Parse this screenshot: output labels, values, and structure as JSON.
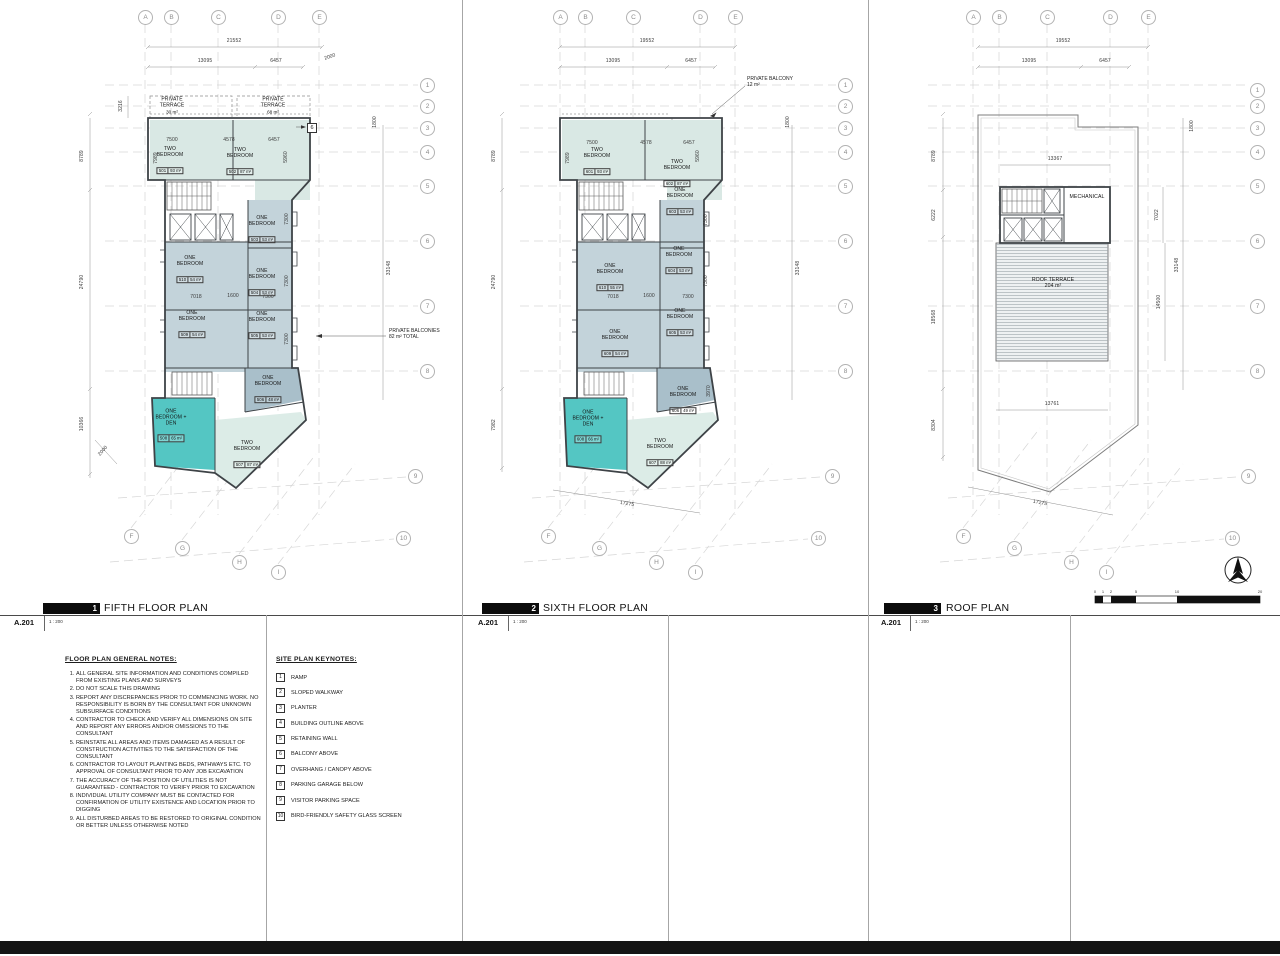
{
  "titles": [
    {
      "no": "1",
      "name": "FIFTH FLOOR PLAN",
      "sheet": "A.201",
      "scale": "1 : 200"
    },
    {
      "no": "2",
      "name": "SIXTH FLOOR PLAN",
      "sheet": "A.201",
      "scale": "1 : 200"
    },
    {
      "no": "3",
      "name": "ROOF PLAN",
      "sheet": "A.201",
      "scale": "1 : 200"
    }
  ],
  "notes": {
    "title": "FLOOR PLAN GENERAL NOTES:",
    "items": [
      "ALL GENERAL SITE INFORMATION AND CONDITIONS COMPILED FROM EXISTING PLANS AND SURVEYS",
      "DO NOT SCALE THIS DRAWING",
      "REPORT ANY DISCREPANCIES PRIOR TO COMMENCING WORK. NO RESPONSIBILITY IS BORN BY THE CONSULTANT FOR UNKNOWN SUBSURFACE CONDITIONS",
      "CONTRACTOR TO CHECK AND VERIFY ALL DIMENSIONS ON SITE AND REPORT ANY ERRORS AND/OR OMISSIONS TO THE CONSULTANT",
      "REINSTATE ALL AREAS AND ITEMS DAMAGED AS A RESULT OF CONSTRUCTION ACTIVITIES TO THE SATISFACTION OF THE CONSULTANT",
      "CONTRACTOR TO LAYOUT PLANTING BEDS, PATHWAYS ETC. TO APPROVAL OF CONSULTANT PRIOR TO ANY JOB EXCAVATION",
      "THE ACCURACY OF THE POSITION OF UTILITIES IS NOT GUARANTEED - CONTRACTOR TO VERIFY PRIOR TO EXCAVATION",
      "INDIVIDUAL UTILITY COMPANY MUST BE CONTACTED FOR CONFIRMATION OF UTILITY EXISTENCE AND LOCATION PRIOR TO DIGGING",
      "ALL DISTURBED AREAS TO BE RESTORED TO ORIGINAL CONDITION OR BETTER UNLESS OTHERWISE NOTED"
    ]
  },
  "keynotes": {
    "title": "SITE PLAN KEYNOTES:",
    "items": [
      {
        "no": "1",
        "label": "RAMP"
      },
      {
        "no": "2",
        "label": "SLOPED WALKWAY"
      },
      {
        "no": "3",
        "label": "PLANTER"
      },
      {
        "no": "4",
        "label": "BUILDING OUTLINE ABOVE"
      },
      {
        "no": "5",
        "label": "RETAINING WALL"
      },
      {
        "no": "6",
        "label": "BALCONY ABOVE"
      },
      {
        "no": "7",
        "label": "OVERHANG / CANOPY ABOVE"
      },
      {
        "no": "8",
        "label": "PARKING GARAGE BELOW"
      },
      {
        "no": "9",
        "label": "VISITOR PARKING SPACE"
      },
      {
        "no": "10",
        "label": "BIRD-FRIENDLY SAFETY GLASS SCREEN"
      }
    ]
  },
  "plan1": {
    "grid_top": [
      "A",
      "B",
      "C",
      "D",
      "E"
    ],
    "grid_right": [
      "1",
      "2",
      "3",
      "4",
      "5",
      "6",
      "7",
      "8",
      "9",
      "10"
    ],
    "grid_bottom": [
      "F",
      "G",
      "H",
      "I"
    ],
    "dims_top": [
      "21552",
      "13095",
      "6457",
      "2000"
    ],
    "dims_left": [
      "3216",
      "8789",
      "24790",
      "10366",
      "2000"
    ],
    "dims_right": [
      "1800",
      "33148"
    ],
    "dims_inner": [
      "7500",
      "4578",
      "6457",
      "7989",
      "5960",
      "7018",
      "1600",
      "7300",
      "7300",
      "7300",
      "7300"
    ],
    "keynote": "6",
    "annotation": "PRIVATE BALCONIES\n82 m² TOTAL",
    "rooms": [
      {
        "name": "PRIVATE\nTERRACE",
        "area": "30 m²"
      },
      {
        "name": "PRIVATE\nTERRACE",
        "area": "68 m²"
      },
      {
        "name": "TWO\nBEDROOM",
        "num": "501",
        "area": "93 m²"
      },
      {
        "name": "TWO\nBEDROOM",
        "num": "502",
        "area": "87 m²"
      },
      {
        "name": "ONE\nBEDROOM",
        "num": "503",
        "area": "53 m²"
      },
      {
        "name": "ONE\nBEDROOM",
        "num": "504",
        "area": "53 m²"
      },
      {
        "name": "ONE\nBEDROOM",
        "num": "505",
        "area": "53 m²"
      },
      {
        "name": "ONE\nBEDROOM",
        "num": "506",
        "area": "48 m²"
      },
      {
        "name": "TWO\nBEDROOM",
        "num": "507",
        "area": "87 m²"
      },
      {
        "name": "ONE\nBEDROOM +\nDEN",
        "num": "508",
        "area": "65 m²"
      },
      {
        "name": "ONE\nBEDROOM",
        "num": "509",
        "area": "54 m²"
      },
      {
        "name": "ONE\nBEDROOM",
        "num": "510",
        "area": "54 m²"
      }
    ]
  },
  "plan2": {
    "grid_top": [
      "A",
      "B",
      "C",
      "D",
      "E"
    ],
    "grid_right": [
      "1",
      "2",
      "3",
      "4",
      "5",
      "6",
      "7",
      "8",
      "9",
      "10"
    ],
    "grid_bottom": [
      "F",
      "G",
      "H",
      "I"
    ],
    "dims_top": [
      "19552",
      "13095",
      "6457"
    ],
    "dims_left": [
      "8789",
      "24790",
      "7982"
    ],
    "dims_right": [
      "1800",
      "33148"
    ],
    "dims_inner": [
      "7500",
      "4578",
      "6457",
      "7989",
      "5960",
      "7018",
      "1600",
      "7300",
      "7300",
      "7300",
      "3970"
    ],
    "dims_bottom": [
      "17275"
    ],
    "annotation": "PRIVATE BALCONY\n12 m²",
    "rooms": [
      {
        "name": "TWO\nBEDROOM",
        "num": "601",
        "area": "93 m²"
      },
      {
        "name": "TWO\nBEDROOM",
        "num": "602",
        "area": "87 m²"
      },
      {
        "name": "ONE\nBEDROOM",
        "num": "603",
        "area": "53 m²"
      },
      {
        "name": "ONE\nBEDROOM",
        "num": "604",
        "area": "53 m²"
      },
      {
        "name": "ONE\nBEDROOM",
        "num": "605",
        "area": "53 m²"
      },
      {
        "name": "ONE\nBEDROOM",
        "num": "606",
        "area": "49 m²"
      },
      {
        "name": "TWO\nBEDROOM",
        "num": "607",
        "area": "88 m²"
      },
      {
        "name": "ONE\nBEDROOM +\nDEN",
        "num": "608",
        "area": "66 m²"
      },
      {
        "name": "ONE\nBEDROOM",
        "num": "609",
        "area": "54 m²"
      },
      {
        "name": "ONE\nBEDROOM",
        "num": "610",
        "area": "55 m²"
      }
    ]
  },
  "plan3": {
    "grid_top": [
      "A",
      "B",
      "C",
      "D",
      "E"
    ],
    "grid_right": [
      "1",
      "2",
      "3",
      "4",
      "5",
      "6",
      "7",
      "8",
      "9",
      "10"
    ],
    "grid_bottom": [
      "F",
      "G",
      "H",
      "I"
    ],
    "dims_top": [
      "19552",
      "13095",
      "6457"
    ],
    "dims_left": [
      "8789",
      "6222",
      "18568",
      "8304"
    ],
    "dims_right": [
      "1800",
      "7022",
      "33148",
      "14500"
    ],
    "dims_inner": [
      "13367",
      "13761"
    ],
    "dims_bottom": [
      "17275"
    ],
    "labels": {
      "mechanical": "MECHANICAL",
      "terrace": "ROOF TERRACE\n204 m²"
    },
    "scalebar": [
      "0",
      "1",
      "2",
      "5",
      "10",
      "20"
    ]
  }
}
